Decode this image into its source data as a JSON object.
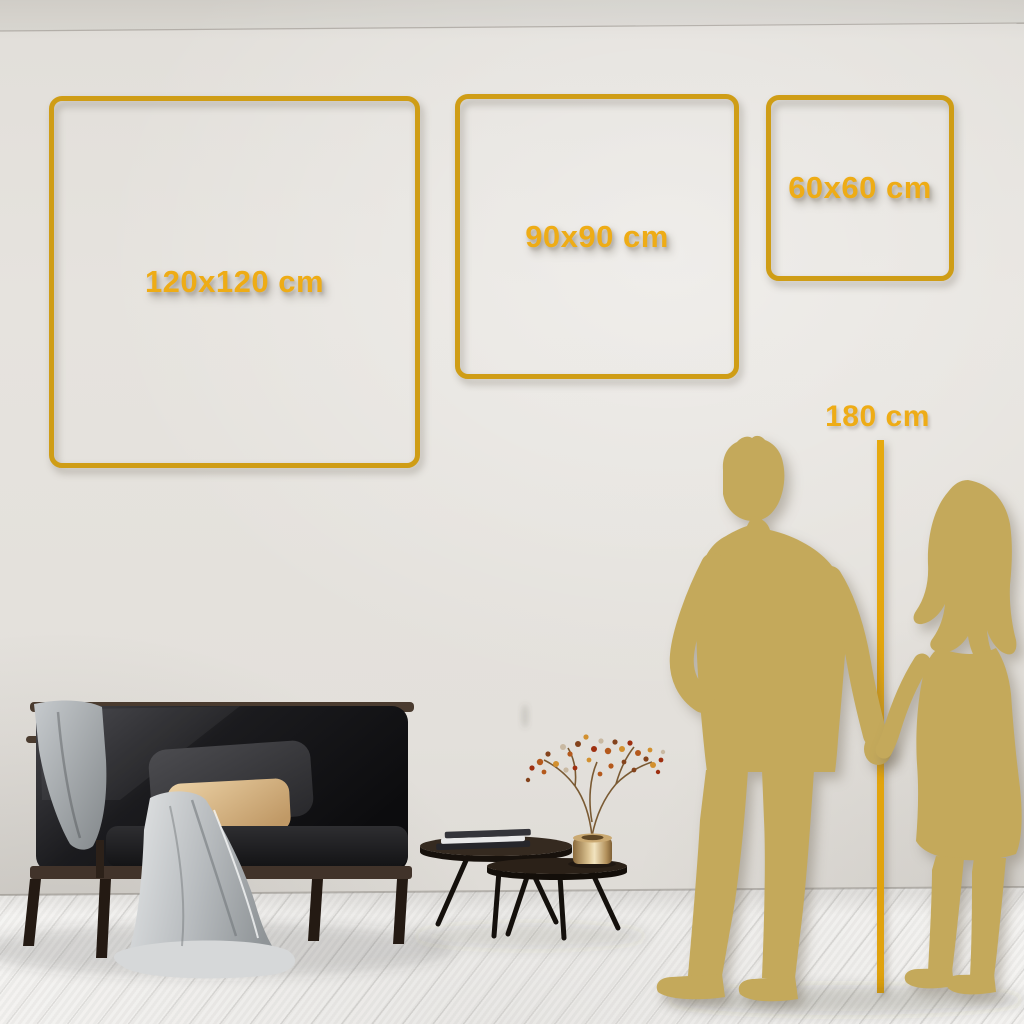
{
  "size_guide": {
    "options": [
      {
        "id": "120x120",
        "label": "120x120 cm"
      },
      {
        "id": "90x90",
        "label": "90x90 cm"
      },
      {
        "id": "60x60",
        "label": "60x60 cm"
      }
    ],
    "reference_height": {
      "label": "180 cm"
    }
  },
  "colors": {
    "frame_gold": "#CF9D16",
    "label_gold": "#EEAC16",
    "ruler_gold": "#DFA10E",
    "silhouette_gold": "#C4A95B",
    "wall": "#E4E1DC",
    "floor": "#F4F3F1"
  },
  "scene_objects": [
    "sofa",
    "throw-blanket",
    "cushions",
    "nesting-coffee-tables",
    "books",
    "brass-vase",
    "dried-flower-branches",
    "man-silhouette",
    "woman-silhouette",
    "wood-floor",
    "wall",
    "ceiling-line"
  ]
}
